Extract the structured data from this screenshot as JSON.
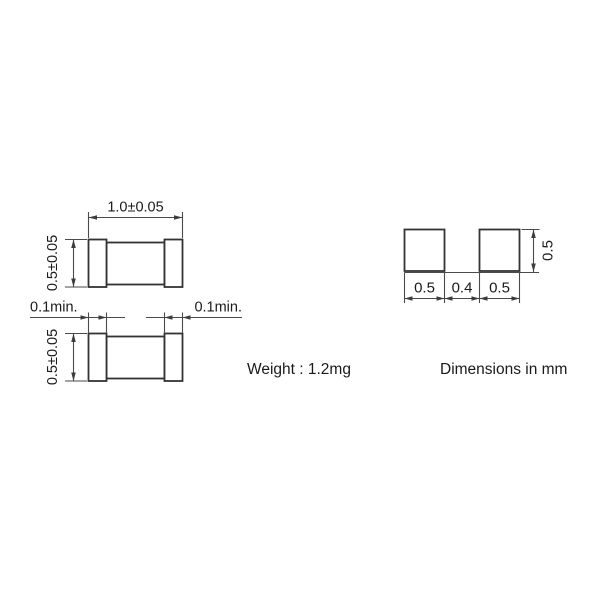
{
  "drawing": {
    "colors": {
      "background": "#ffffff",
      "outline": "#333333",
      "dimension_lines": "#4a4a4a",
      "text": "#1a1a1a"
    },
    "top_view": {
      "length_label": "1.0±0.05",
      "height_label": "0.5±0.05"
    },
    "bottom_view": {
      "height_label": "0.5±0.05",
      "termination_left_label": "0.1min.",
      "termination_right_label": "0.1min."
    },
    "weight_note": "Weight : 1.2mg",
    "land_pattern": {
      "pad_left_width_label": "0.5",
      "gap_label": "0.4",
      "pad_right_width_label": "0.5",
      "pad_height_label": "0.5"
    },
    "units_note": "Dimensions in mm"
  }
}
